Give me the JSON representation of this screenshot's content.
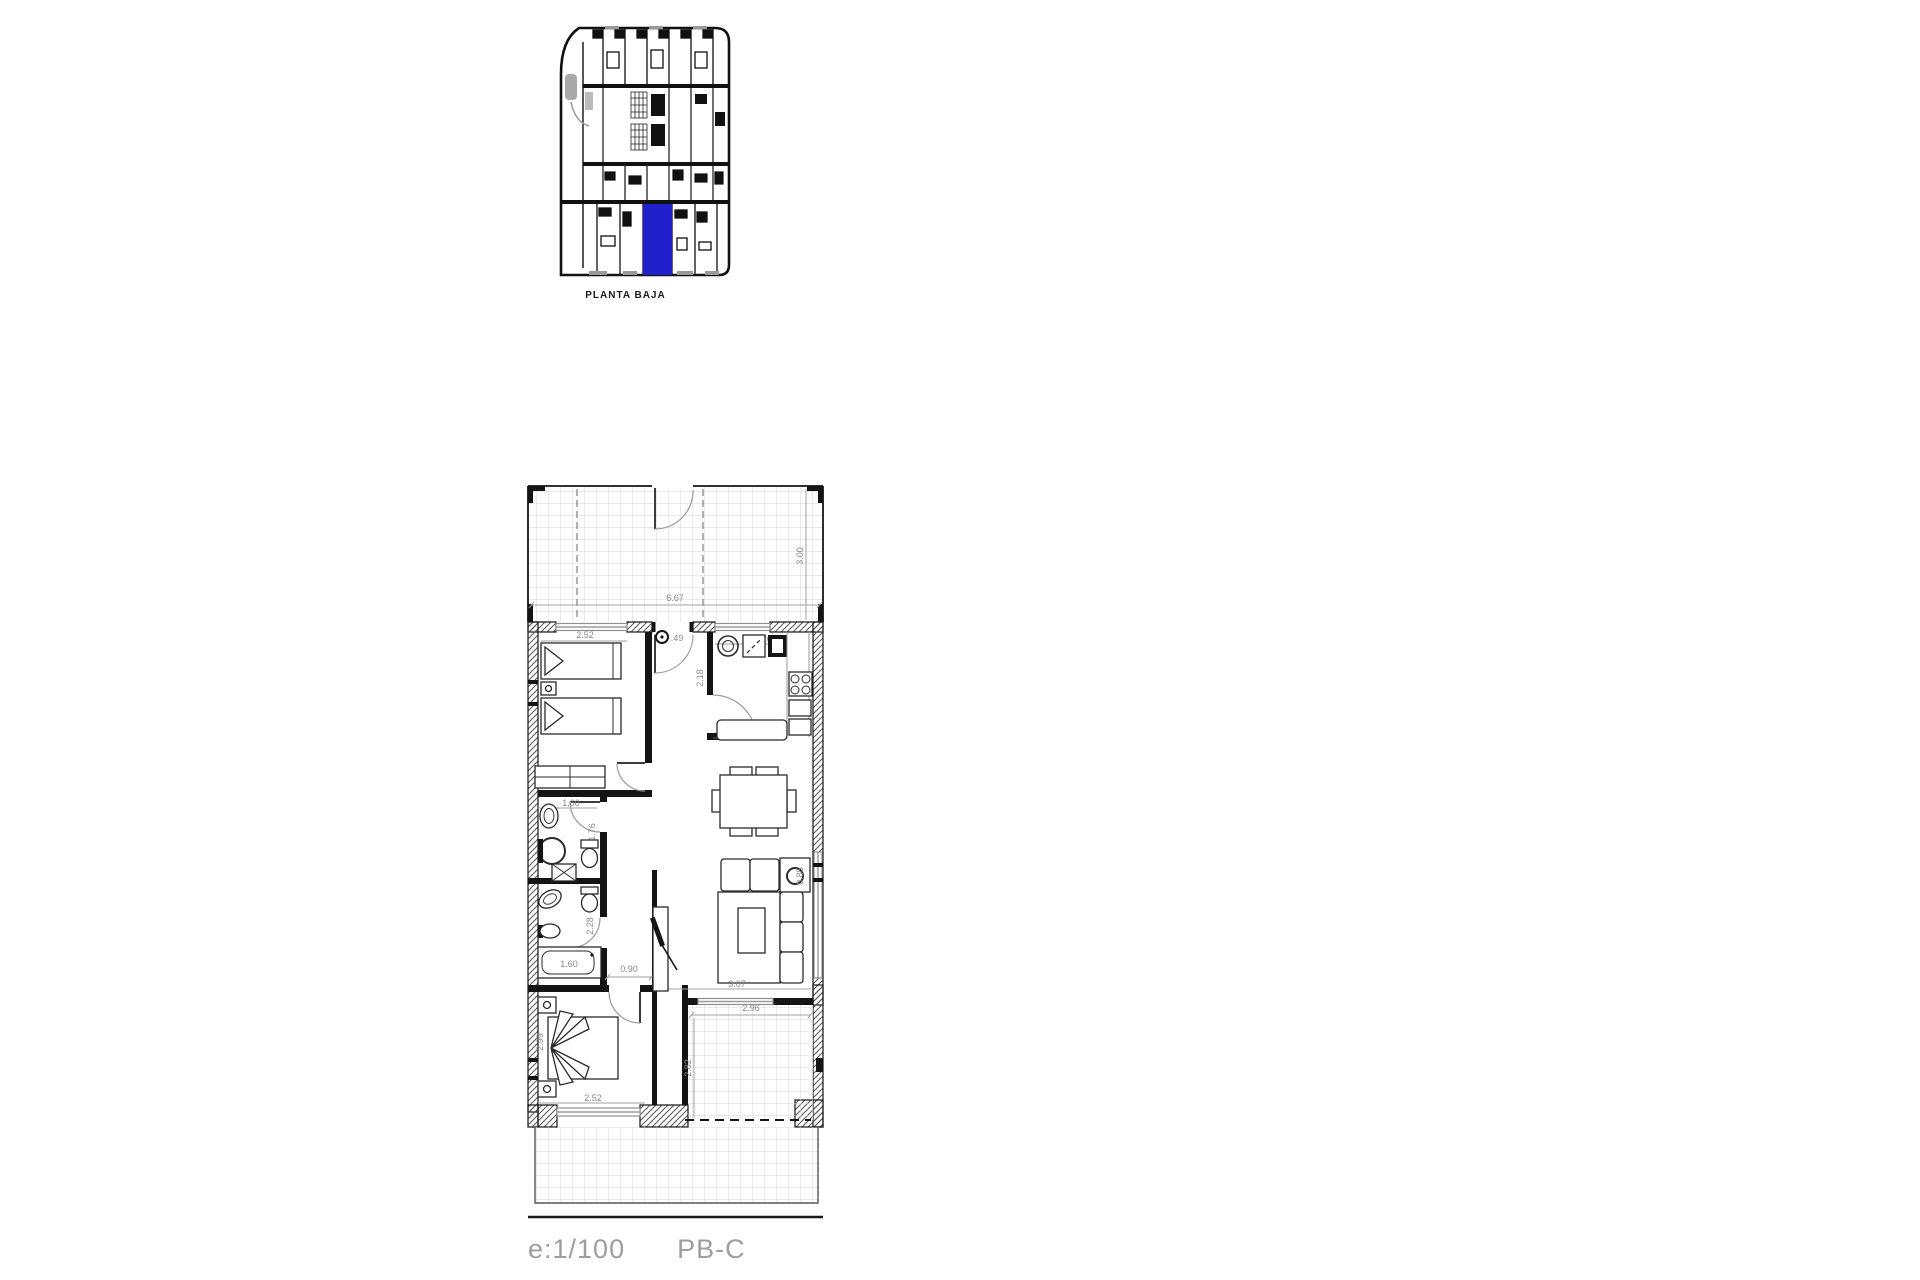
{
  "overview": {
    "label": "PLANTA BAJA",
    "highlight_color": "#2121cc"
  },
  "footer": {
    "scale": "e:1/100",
    "unit_code": "PB-C"
  },
  "plan": {
    "dims": {
      "terrace_width": "6.67",
      "terrace_depth": "3.00",
      "bedroom1_width": "2.52",
      "entry_symbol_value": ".49",
      "kitchen_width": "2.26",
      "kitchen_depth": "2.18",
      "bath1_width": "1.60",
      "bath1_depth": "1.76",
      "bath2_depth": "2.28",
      "bathtub_length": "1.60",
      "hall_width": "0.90",
      "sofa_corner": "0.85",
      "living_width": "3.07",
      "terrace2_width": "2.96",
      "terrace2_depth": "2.82",
      "bedroom2_depth": "2.99",
      "bedroom2_width": "2.52"
    },
    "colors": {
      "dimension_text": "#8a8a8a",
      "walls": "#141414",
      "tile_grid": "#d6d6d6"
    }
  }
}
